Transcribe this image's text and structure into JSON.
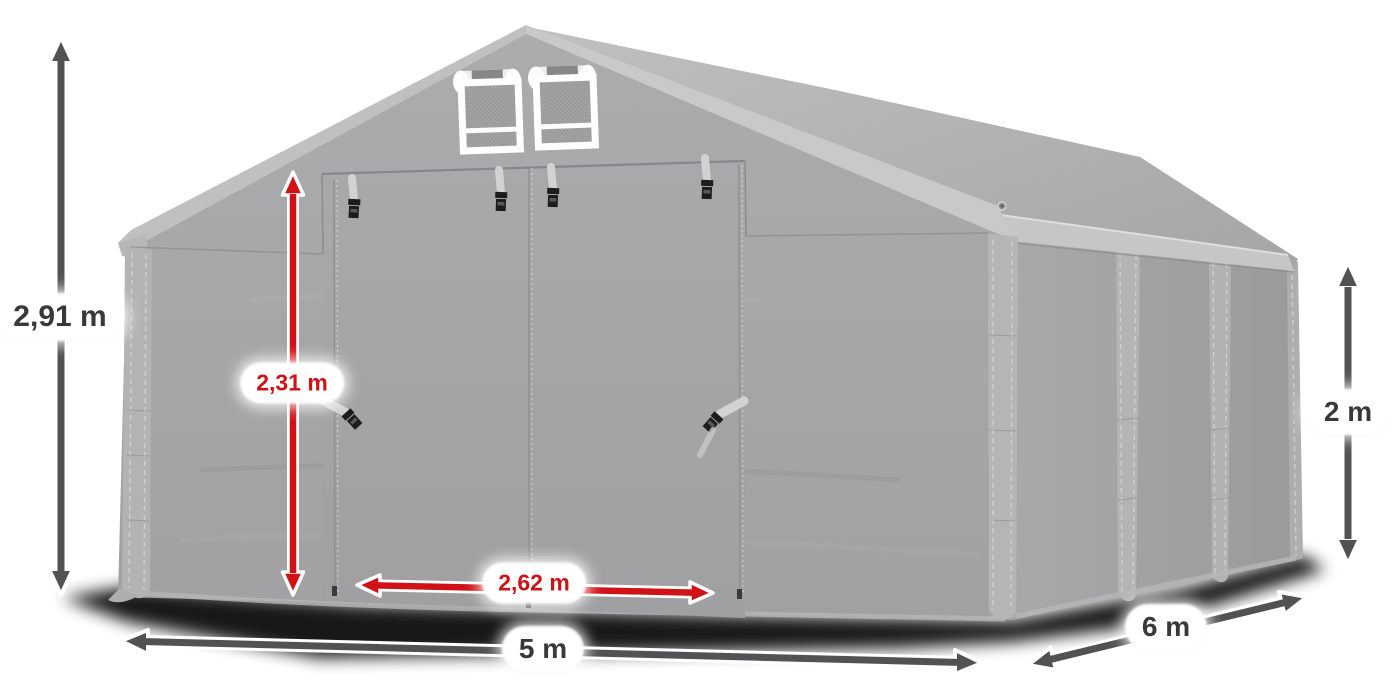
{
  "illustration": {
    "subject": "gray storage tent product illustration with measurement arrows",
    "background": "#ffffff",
    "colors": {
      "tent_light_gray": "#c6c6c8",
      "tent_mid_gray": "#a7a7a9",
      "tent_dark_gray": "#98989a",
      "shadow_black": "#000000",
      "arrow_dark": "#525254",
      "accent_red": "#d01217",
      "label_text_dark": "#39393b",
      "label_pill_bg": "#ffffff"
    },
    "dimensions": {
      "total_height": "2,91 m",
      "door_height": "2,31 m",
      "door_width": "2,62 m",
      "front_width": "5 m",
      "side_depth": "6 m",
      "wall_height": "2 m"
    }
  }
}
